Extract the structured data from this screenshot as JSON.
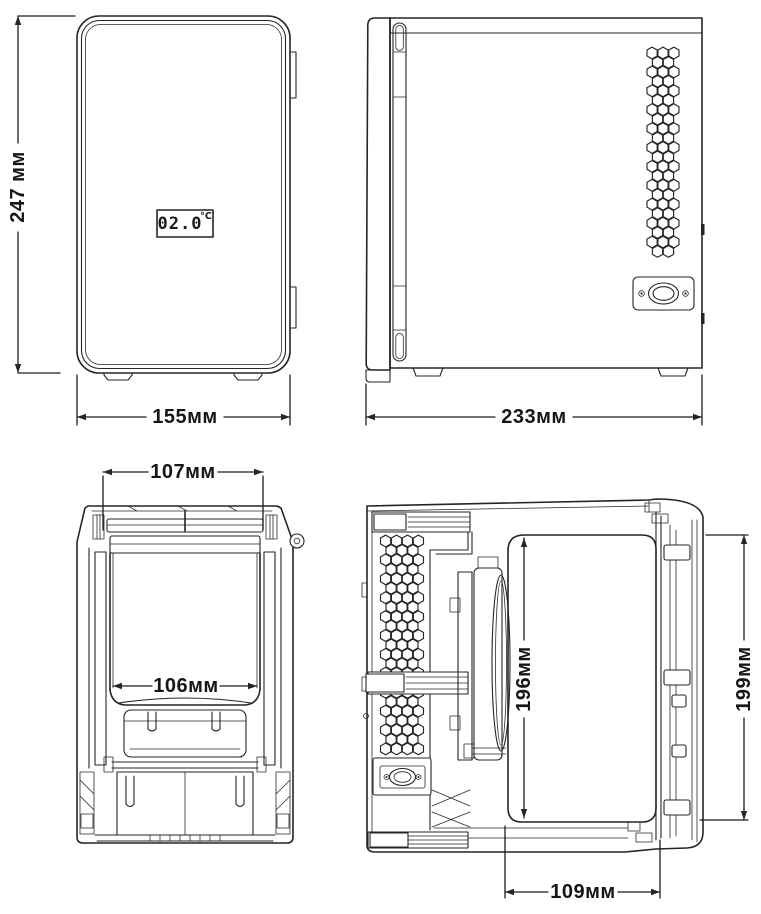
{
  "colors": {
    "line": "#252525",
    "label": "#161616",
    "background": "#ffffff"
  },
  "views": {
    "front": {
      "display": {
        "value": "02.0",
        "unit": "°C"
      },
      "dims": {
        "height": "247 мм",
        "width": "155мм"
      }
    },
    "side": {
      "dims": {
        "depth": "233мм"
      }
    },
    "front_section": {
      "dims": {
        "lid_width": "107мм",
        "chamber_width": "106мм"
      }
    },
    "side_section": {
      "dims": {
        "chamber_height": "196мм",
        "door_height": "199мм",
        "chamber_depth": "109мм"
      }
    }
  }
}
